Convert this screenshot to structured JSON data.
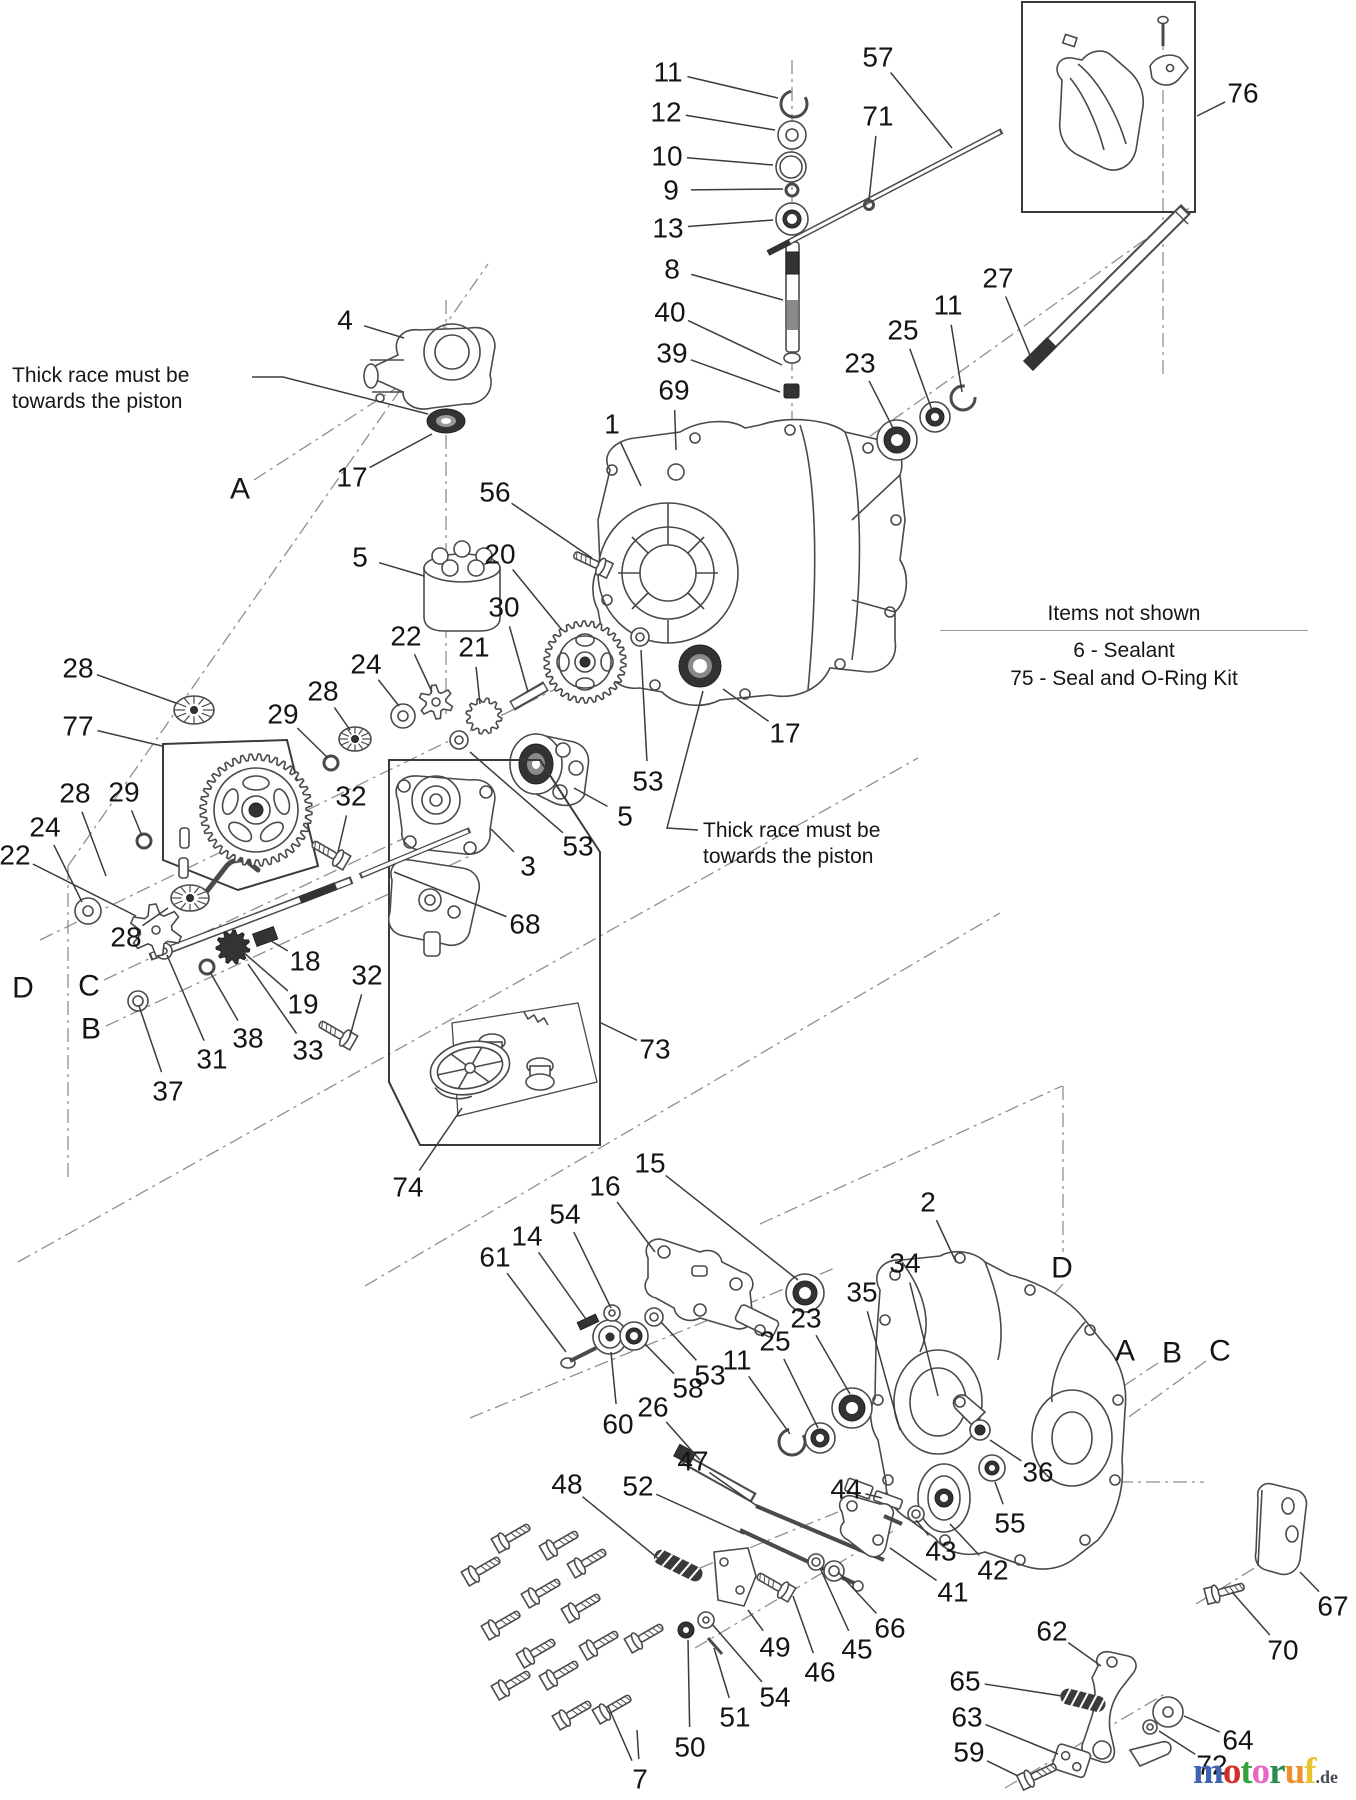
{
  "page": {
    "width": 1356,
    "height": 1800,
    "background": "#ffffff"
  },
  "colors": {
    "label": "#141414",
    "leader": "#3c3c3c",
    "stroke": "#4a4a4a",
    "dash": "#8f8f8f",
    "dark_fill": "#333333"
  },
  "notes": {
    "thick_race_left": {
      "line1": "Thick race must be",
      "line2": "towards the piston"
    },
    "thick_race_right": {
      "line1": "Thick race must be",
      "line2": "towards the piston"
    }
  },
  "items_not_shown": {
    "title": "Items not shown",
    "items": [
      "6 - Sealant",
      "75 - Seal and O-Ring Kit"
    ]
  },
  "logo": {
    "letters": [
      {
        "ch": "m",
        "color": "#3f63ae"
      },
      {
        "ch": "o",
        "color": "#d03028"
      },
      {
        "ch": "t",
        "color": "#35a03c"
      },
      {
        "ch": "o",
        "color": "#e468c4"
      },
      {
        "ch": "r",
        "color": "#2e8b4f"
      },
      {
        "ch": "u",
        "color": "#ef8f2f"
      },
      {
        "ch": "f",
        "color": "#e8c32c"
      }
    ],
    "suffix": ".de"
  },
  "callouts": [
    {
      "label": "11",
      "x": 668,
      "y": 72,
      "tx": 778,
      "ty": 98
    },
    {
      "label": "12",
      "x": 666,
      "y": 112,
      "tx": 775,
      "ty": 130
    },
    {
      "label": "10",
      "x": 667,
      "y": 156,
      "tx": 773,
      "ty": 165
    },
    {
      "label": "9",
      "x": 671,
      "y": 190,
      "tx": 783,
      "ty": 189
    },
    {
      "label": "13",
      "x": 668,
      "y": 228,
      "tx": 773,
      "ty": 220
    },
    {
      "label": "8",
      "x": 672,
      "y": 269,
      "tx": 783,
      "ty": 300
    },
    {
      "label": "40",
      "x": 670,
      "y": 312,
      "tx": 782,
      "ty": 365
    },
    {
      "label": "39",
      "x": 672,
      "y": 353,
      "tx": 780,
      "ty": 392
    },
    {
      "label": "69",
      "x": 674,
      "y": 390,
      "tx": 676,
      "ty": 450
    },
    {
      "label": "57",
      "x": 878,
      "y": 57,
      "tx": 952,
      "ty": 148
    },
    {
      "label": "71",
      "x": 878,
      "y": 116,
      "tx": 869,
      "ty": 200
    },
    {
      "label": "76",
      "x": 1243,
      "y": 93,
      "tx": 1197,
      "ty": 116
    },
    {
      "label": "27",
      "x": 998,
      "y": 278,
      "tx": 1032,
      "ty": 360
    },
    {
      "label": "11",
      "x": 948,
      "y": 305,
      "tx": 962,
      "ty": 392
    },
    {
      "label": "25",
      "x": 903,
      "y": 330,
      "tx": 932,
      "ty": 410
    },
    {
      "label": "23",
      "x": 860,
      "y": 363,
      "tx": 893,
      "ty": 428
    },
    {
      "label": "4",
      "x": 345,
      "y": 320,
      "tx": 404,
      "ty": 338
    },
    {
      "label": "A",
      "x": 240,
      "y": 489
    },
    {
      "label": "17",
      "x": 352,
      "y": 477,
      "tx": 432,
      "ty": 434
    },
    {
      "label": "56",
      "x": 495,
      "y": 492,
      "tx": 592,
      "ty": 558
    },
    {
      "label": "5",
      "x": 360,
      "y": 557,
      "tx": 424,
      "ty": 576
    },
    {
      "label": "20",
      "x": 500,
      "y": 554,
      "tx": 562,
      "ty": 630
    },
    {
      "label": "30",
      "x": 504,
      "y": 607,
      "tx": 528,
      "ty": 692
    },
    {
      "label": "22",
      "x": 406,
      "y": 636,
      "tx": 432,
      "ty": 692
    },
    {
      "label": "21",
      "x": 474,
      "y": 647,
      "tx": 480,
      "ty": 704
    },
    {
      "label": "24",
      "x": 366,
      "y": 664,
      "tx": 399,
      "ty": 706
    },
    {
      "label": "28",
      "x": 323,
      "y": 691,
      "tx": 350,
      "ty": 730
    },
    {
      "label": "29",
      "x": 283,
      "y": 714,
      "tx": 328,
      "ty": 758
    },
    {
      "label": "1",
      "x": 612,
      "y": 424,
      "tx": 641,
      "ty": 486
    },
    {
      "label": "28",
      "x": 78,
      "y": 668,
      "tx": 176,
      "ty": 703
    },
    {
      "label": "77",
      "x": 78,
      "y": 726,
      "tx": 162,
      "ty": 746
    },
    {
      "label": "28",
      "x": 75,
      "y": 793,
      "tx": 106,
      "ty": 876
    },
    {
      "label": "29",
      "x": 124,
      "y": 792,
      "tx": 142,
      "ty": 836
    },
    {
      "label": "24",
      "x": 45,
      "y": 827,
      "tx": 82,
      "ty": 902
    },
    {
      "label": "22",
      "x": 15,
      "y": 855,
      "tx": 136,
      "ty": 916
    },
    {
      "label": "17",
      "x": 785,
      "y": 733,
      "tx": 723,
      "ty": 689
    },
    {
      "label": "53",
      "x": 648,
      "y": 781,
      "tx": 641,
      "ty": 650
    },
    {
      "label": "5",
      "x": 625,
      "y": 816,
      "tx": 574,
      "ty": 788
    },
    {
      "label": "53",
      "x": 578,
      "y": 846,
      "tx": 470,
      "ty": 752
    },
    {
      "label": "3",
      "x": 528,
      "y": 866,
      "tx": 491,
      "ty": 829
    },
    {
      "label": "68",
      "x": 525,
      "y": 924,
      "tx": 394,
      "ty": 872
    },
    {
      "label": "32",
      "x": 351,
      "y": 796,
      "tx": 338,
      "ty": 852
    },
    {
      "label": "32",
      "x": 367,
      "y": 975,
      "tx": 350,
      "ty": 1036
    },
    {
      "label": "28",
      "x": 126,
      "y": 937,
      "tx": 168,
      "ty": 908
    },
    {
      "label": "18",
      "x": 305,
      "y": 961,
      "tx": 266,
      "ty": 938
    },
    {
      "label": "19",
      "x": 303,
      "y": 1004,
      "tx": 243,
      "ty": 952
    },
    {
      "label": "38",
      "x": 248,
      "y": 1038,
      "tx": 210,
      "ty": 972
    },
    {
      "label": "33",
      "x": 308,
      "y": 1050,
      "tx": 248,
      "ty": 964
    },
    {
      "label": "31",
      "x": 212,
      "y": 1059,
      "tx": 167,
      "ty": 955
    },
    {
      "label": "37",
      "x": 168,
      "y": 1091,
      "tx": 139,
      "ty": 1006
    },
    {
      "label": "D",
      "x": 23,
      "y": 988
    },
    {
      "label": "C",
      "x": 89,
      "y": 986
    },
    {
      "label": "B",
      "x": 91,
      "y": 1029
    },
    {
      "label": "73",
      "x": 655,
      "y": 1049,
      "tx": 599,
      "ty": 1022
    },
    {
      "label": "74",
      "x": 408,
      "y": 1187,
      "tx": 462,
      "ty": 1108
    },
    {
      "label": "16",
      "x": 605,
      "y": 1186,
      "tx": 655,
      "ty": 1252
    },
    {
      "label": "15",
      "x": 650,
      "y": 1163,
      "tx": 798,
      "ty": 1280
    },
    {
      "label": "54",
      "x": 565,
      "y": 1214,
      "tx": 611,
      "ty": 1308
    },
    {
      "label": "14",
      "x": 527,
      "y": 1236,
      "tx": 588,
      "ty": 1322
    },
    {
      "label": "61",
      "x": 495,
      "y": 1257,
      "tx": 566,
      "ty": 1352
    },
    {
      "label": "60",
      "x": 618,
      "y": 1424,
      "tx": 611,
      "ty": 1352
    },
    {
      "label": "58",
      "x": 688,
      "y": 1388,
      "tx": 645,
      "ty": 1344
    },
    {
      "label": "26",
      "x": 653,
      "y": 1407,
      "tx": 700,
      "ty": 1460
    },
    {
      "label": "53",
      "x": 710,
      "y": 1375,
      "tx": 661,
      "ty": 1322
    },
    {
      "label": "11",
      "x": 737,
      "y": 1360,
      "tx": 790,
      "ty": 1434
    },
    {
      "label": "25",
      "x": 775,
      "y": 1341,
      "tx": 818,
      "ty": 1428
    },
    {
      "label": "23",
      "x": 806,
      "y": 1318,
      "tx": 850,
      "ty": 1394
    },
    {
      "label": "47",
      "x": 693,
      "y": 1461,
      "tx": 760,
      "ty": 1508
    },
    {
      "label": "48",
      "x": 567,
      "y": 1484,
      "tx": 660,
      "ty": 1560
    },
    {
      "label": "52",
      "x": 638,
      "y": 1486,
      "tx": 744,
      "ty": 1534
    },
    {
      "label": "2",
      "x": 928,
      "y": 1202,
      "tx": 956,
      "ty": 1262
    },
    {
      "label": "34",
      "x": 905,
      "y": 1263,
      "tx": 938,
      "ty": 1396
    },
    {
      "label": "35",
      "x": 862,
      "y": 1292,
      "tx": 900,
      "ty": 1430
    },
    {
      "label": "D",
      "x": 1062,
      "y": 1268
    },
    {
      "label": "A",
      "x": 1125,
      "y": 1351
    },
    {
      "label": "B",
      "x": 1172,
      "y": 1353
    },
    {
      "label": "C",
      "x": 1220,
      "y": 1351
    },
    {
      "label": "36",
      "x": 1038,
      "y": 1472,
      "tx": 990,
      "ty": 1440
    },
    {
      "label": "55",
      "x": 1010,
      "y": 1523,
      "tx": 995,
      "ty": 1482
    },
    {
      "label": "44",
      "x": 846,
      "y": 1489,
      "tx": 882,
      "ty": 1498
    },
    {
      "label": "43",
      "x": 941,
      "y": 1551,
      "tx": 916,
      "ty": 1520
    },
    {
      "label": "42",
      "x": 993,
      "y": 1570,
      "tx": 950,
      "ty": 1524
    },
    {
      "label": "41",
      "x": 953,
      "y": 1592,
      "tx": 890,
      "ty": 1548
    },
    {
      "label": "66",
      "x": 890,
      "y": 1628,
      "tx": 838,
      "ty": 1572
    },
    {
      "label": "45",
      "x": 857,
      "y": 1649,
      "tx": 820,
      "ty": 1568
    },
    {
      "label": "46",
      "x": 820,
      "y": 1672,
      "tx": 793,
      "ty": 1596
    },
    {
      "label": "49",
      "x": 775,
      "y": 1647,
      "tx": 748,
      "ty": 1610
    },
    {
      "label": "54",
      "x": 775,
      "y": 1697,
      "tx": 712,
      "ty": 1624
    },
    {
      "label": "51",
      "x": 735,
      "y": 1717,
      "tx": 714,
      "ty": 1648
    },
    {
      "label": "50",
      "x": 690,
      "y": 1747,
      "tx": 688,
      "ty": 1640
    },
    {
      "label": "7",
      "x": 640,
      "y": 1779,
      "tx": 608,
      "ty": 1706,
      "tx2": 637,
      "ty2": 1730
    },
    {
      "label": "62",
      "x": 1052,
      "y": 1631,
      "tx": 1101,
      "ty": 1666
    },
    {
      "label": "65",
      "x": 965,
      "y": 1681,
      "tx": 1062,
      "ty": 1696
    },
    {
      "label": "63",
      "x": 967,
      "y": 1717,
      "tx": 1058,
      "ty": 1754
    },
    {
      "label": "59",
      "x": 969,
      "y": 1752,
      "tx": 1018,
      "ty": 1776
    },
    {
      "label": "64",
      "x": 1238,
      "y": 1740,
      "tx": 1184,
      "ty": 1716
    },
    {
      "label": "72",
      "x": 1212,
      "y": 1765,
      "tx": 1159,
      "ty": 1731
    },
    {
      "label": "67",
      "x": 1333,
      "y": 1606,
      "tx": 1300,
      "ty": 1572
    },
    {
      "label": "70",
      "x": 1283,
      "y": 1650,
      "tx": 1232,
      "ty": 1592
    }
  ]
}
